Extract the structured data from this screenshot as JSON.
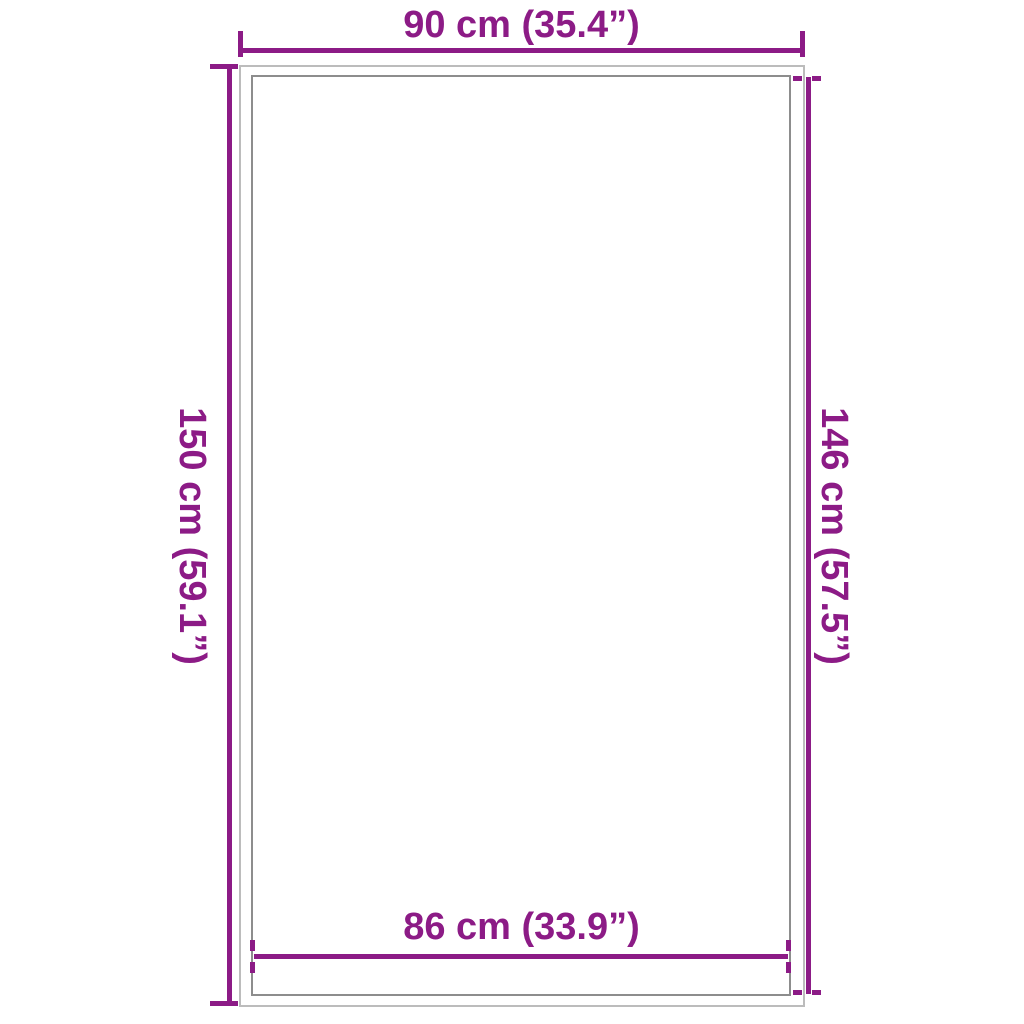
{
  "diagram": {
    "type": "product-dimension-drawing",
    "background_color": "#ffffff",
    "accent_color": "#8C1B86",
    "outer_rect_border_color": "#bcbcbc",
    "inner_rect_border_color": "#8d8d8d",
    "dimensions": {
      "top": {
        "label": "90 cm (35.4”)",
        "value_cm": 90,
        "value_inches": 35.4,
        "measures": "outer-width",
        "tick_style": "solid"
      },
      "left": {
        "label": "150 cm (59.1”)",
        "value_cm": 150,
        "value_inches": 59.1,
        "measures": "outer-height",
        "tick_style": "solid"
      },
      "right": {
        "label": "146 cm (57.5”)",
        "value_cm": 146,
        "value_inches": 57.5,
        "measures": "inner-height",
        "tick_style": "dashed"
      },
      "bottom": {
        "label": "86 cm (33.9”)",
        "value_cm": 86,
        "value_inches": 33.9,
        "measures": "inner-width",
        "tick_style": "dashed"
      }
    }
  }
}
